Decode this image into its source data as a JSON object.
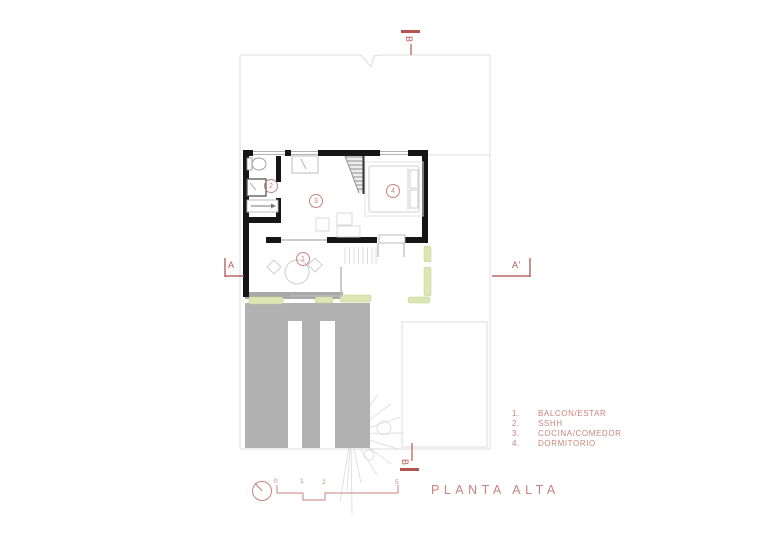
{
  "title": "PLANTA ALTA",
  "legend": {
    "items": [
      {
        "num": "1.",
        "label": "BALCON/ESTAR"
      },
      {
        "num": "2.",
        "label": "SSHH"
      },
      {
        "num": "3.",
        "label": "COCINA/COMEDOR"
      },
      {
        "num": "4.",
        "label": "DORMITORIO"
      }
    ]
  },
  "rooms": {
    "balcon_estar": "1",
    "sshh": "2",
    "cocina_comedor": "3",
    "dormitorio": "4"
  },
  "sections": {
    "a_left": "A",
    "a_right": "A'",
    "b_top": "B",
    "b_bottom": "B"
  },
  "scale_bar": {
    "ticks": [
      "0",
      "1",
      "2",
      "5"
    ]
  },
  "colors": {
    "annotation_salmon": "#c9837c",
    "marker_red": "#b2564e",
    "wall_black": "#161616",
    "planter_green": "#dde6b4",
    "roof_gray": "#b1b1b1",
    "boundary_gray": "#dcdcdc"
  }
}
